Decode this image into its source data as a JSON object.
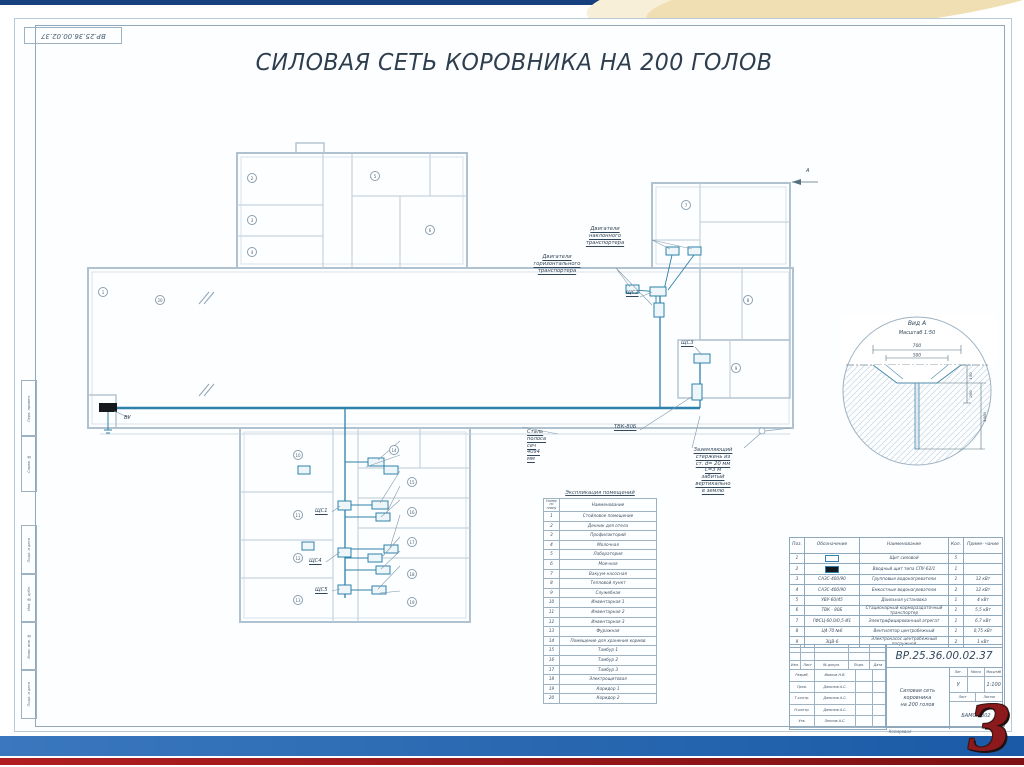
{
  "slide": {
    "page_number": "3"
  },
  "colors": {
    "top_bar": "#16417e",
    "swoosh": "#f0dfb2",
    "bottom_bar_blue": "#1a5aa6",
    "bottom_bar_red": "#a01418",
    "network_line": "#2d81aa",
    "walls": "#b0c2d0",
    "page_number_red": "#8c191c"
  },
  "sheet": {
    "stamp": "ВР.25.36.00.02.37",
    "title": "СИЛОВАЯ СЕТЬ КОРОВНИКА НА 200 ГОЛОВ"
  },
  "frame_left": [
    "Перв. примен.",
    "Справ. №",
    "Подп. и дата",
    "Инв. № дубл.",
    "Взам. инв. №",
    "Подп. и дата"
  ],
  "plan": {
    "labels": [
      {
        "id": "motor-incline",
        "text": "Двигатели наклонного\nтранспортера",
        "x": 605,
        "y": 226,
        "align": "c",
        "u": true
      },
      {
        "id": "motor-horiz",
        "text": "Двигатели горизонтального\nтранспортера",
        "x": 557,
        "y": 254,
        "align": "c",
        "u": true
      },
      {
        "id": "shchs2",
        "text": "ЩС2",
        "x": 626,
        "y": 290,
        "u": true
      },
      {
        "id": "shchs3",
        "text": "ЩС3",
        "x": 681,
        "y": 340,
        "u": true
      },
      {
        "id": "tvk-80b",
        "text": "ТВК-80Б",
        "x": 614,
        "y": 424,
        "u": true
      },
      {
        "id": "steel-strip",
        "text": "Сталь полоса сеч 40х4 мм",
        "x": 527,
        "y": 429,
        "u": true
      },
      {
        "id": "ground-note",
        "text": "Заземляющий стержень из ст. d= 20 мм\nL=3 м забитый вертикально в землю",
        "x": 713,
        "y": 447,
        "align": "c",
        "u": true
      },
      {
        "id": "vu-panel",
        "text": "ВУ",
        "x": 124,
        "y": 415
      },
      {
        "id": "shchs1",
        "text": "ЩС1",
        "x": 315,
        "y": 508,
        "u": true
      },
      {
        "id": "shchs4",
        "text": "ЩС4",
        "x": 309,
        "y": 558,
        "u": true
      },
      {
        "id": "shchs5",
        "text": "ЩС5",
        "x": 315,
        "y": 587,
        "u": true
      },
      {
        "id": "view-arrow",
        "text": "А",
        "x": 806,
        "y": 168
      }
    ],
    "cable_labels": [
      {
        "text": "ГФСЦ-60.0/0,5-И1",
        "y": 434
      },
      {
        "text": "Ц4-70 №6",
        "y": 448
      },
      {
        "text": "ЗЦВ-6",
        "y": 464
      },
      {
        "text": "САЗС 400/90",
        "y": 479
      },
      {
        "text": "УВУ 60/45",
        "y": 493
      },
      {
        "text": "САЗС 400/90",
        "y": 508
      },
      {
        "text": "САЗС 400/90",
        "y": 530
      },
      {
        "text": "УВУ 60/45",
        "y": 545
      },
      {
        "text": "ЗЦВ-6",
        "y": 559
      },
      {
        "text": "САЗС 400/90",
        "y": 585
      }
    ],
    "markers": [
      {
        "n": "1",
        "x": 103,
        "y": 292
      },
      {
        "n": "2",
        "x": 252,
        "y": 178
      },
      {
        "n": "3",
        "x": 252,
        "y": 220
      },
      {
        "n": "4",
        "x": 252,
        "y": 252
      },
      {
        "n": "5",
        "x": 375,
        "y": 176
      },
      {
        "n": "6",
        "x": 430,
        "y": 230
      },
      {
        "n": "7",
        "x": 686,
        "y": 205
      },
      {
        "n": "8",
        "x": 748,
        "y": 300
      },
      {
        "n": "9",
        "x": 736,
        "y": 368
      },
      {
        "n": "10",
        "x": 298,
        "y": 455
      },
      {
        "n": "11",
        "x": 298,
        "y": 515
      },
      {
        "n": "12",
        "x": 298,
        "y": 558
      },
      {
        "n": "13",
        "x": 298,
        "y": 600
      },
      {
        "n": "14",
        "x": 394,
        "y": 450
      },
      {
        "n": "15",
        "x": 412,
        "y": 482
      },
      {
        "n": "16",
        "x": 412,
        "y": 512
      },
      {
        "n": "17",
        "x": 412,
        "y": 542
      },
      {
        "n": "18",
        "x": 412,
        "y": 574
      },
      {
        "n": "19",
        "x": 412,
        "y": 602
      },
      {
        "n": "20",
        "x": 160,
        "y": 300
      }
    ]
  },
  "explication": {
    "title": "Экспликация помещений",
    "col_num": "Номер по плану",
    "col_name": "Наименование",
    "rows": [
      [
        "1",
        "Стойловое помещение"
      ],
      [
        "2",
        "Денник для отела"
      ],
      [
        "3",
        "Профилакторий"
      ],
      [
        "4",
        "Молочная"
      ],
      [
        "5",
        "Лаборатория"
      ],
      [
        "6",
        "Моечная"
      ],
      [
        "7",
        "Вакуум-насосная"
      ],
      [
        "8",
        "Тепловой пункт"
      ],
      [
        "9",
        "Служебная"
      ],
      [
        "10",
        "Инвентарная 1"
      ],
      [
        "11",
        "Инвентарная 2"
      ],
      [
        "12",
        "Инвентарная 3"
      ],
      [
        "13",
        "Фуражная"
      ],
      [
        "14",
        "Помещение для хранения кормов"
      ],
      [
        "15",
        "Тамбур 1"
      ],
      [
        "16",
        "Тамбур 2"
      ],
      [
        "17",
        "Тамбур 3"
      ],
      [
        "18",
        "Электрощитовая"
      ],
      [
        "19",
        "Коридор 1"
      ],
      [
        "20",
        "Коридор 2"
      ]
    ]
  },
  "specification": {
    "headers": [
      "Поз.",
      "Обозначение",
      "Наименование",
      "Кол.",
      "Приме- чание"
    ],
    "rows": [
      {
        "pos": "1",
        "code": "",
        "symbol": "outline",
        "name": "Щит силовой",
        "qty": "5",
        "note": ""
      },
      {
        "pos": "2",
        "code": "",
        "symbol": "filled",
        "name": "Вводный щит типа СПУ-62/1",
        "qty": "1",
        "note": ""
      },
      {
        "pos": "3",
        "code": "САЗС-400/90",
        "symbol": "",
        "name": "Групповые водонагреватели",
        "qty": "1",
        "note": "12 кВт"
      },
      {
        "pos": "4",
        "code": "САЗС-400/90",
        "symbol": "",
        "name": "Емкостные водонагреватели",
        "qty": "2",
        "note": "12 кВт"
      },
      {
        "pos": "5",
        "code": "УВУ-60/45",
        "symbol": "",
        "name": "Доильная установка",
        "qty": "1",
        "note": "4 кВт"
      },
      {
        "pos": "6",
        "code": "ТВК - 80Б",
        "symbol": "",
        "name": "Стационарный кормораздаточный транспортер",
        "qty": "1",
        "note": "5,5 кВт"
      },
      {
        "pos": "7",
        "code": "ГФСЦ-60.0/0,5-И1",
        "symbol": "",
        "name": "Электрифицированный агрегат",
        "qty": "1",
        "note": "6,7 кВт"
      },
      {
        "pos": "8",
        "code": "Ц4-70 №6",
        "symbol": "",
        "name": "Вентилятор центробежный",
        "qty": "1",
        "note": "0,75 кВт"
      },
      {
        "pos": "9",
        "code": "ЗЦВ-6",
        "symbol": "",
        "name": "Электронасос центробежный погружной",
        "qty": "2",
        "note": "1 кВт"
      }
    ]
  },
  "title_block": {
    "doc_number": "ВР.25.36.00.02.37",
    "doc_title": "Силовая сеть\nкоровника\nна 200 голов",
    "header_cells": [
      "Изм.",
      "Лист",
      "№ докум.",
      "Подп.",
      "Дата"
    ],
    "sig_rows": [
      [
        "Разраб.",
        "Иванов Н.В."
      ],
      [
        "Пров.",
        "Данилов А.С."
      ],
      [
        "Т.контр.",
        "Данилов А.С."
      ],
      [
        "Н.контр.",
        "Данилов А.С."
      ],
      [
        "Утв.",
        "Леонов А.С."
      ]
    ],
    "lit_label": "Лит.",
    "mass_label": "Масса",
    "scale_label": "Масштаб",
    "lit": "У",
    "scale": "1:100",
    "sheet_label": "Лист",
    "sheets_label": "Листов",
    "org": "БАМСХ 302",
    "kopiroval": "Копировал"
  },
  "view_detail": {
    "title": "Вид А",
    "subtitle": "Масштаб 1:50",
    "dims": {
      "top": "700",
      "inner": "500",
      "d1": "150",
      "d2": "200",
      "depth": "1000"
    }
  }
}
